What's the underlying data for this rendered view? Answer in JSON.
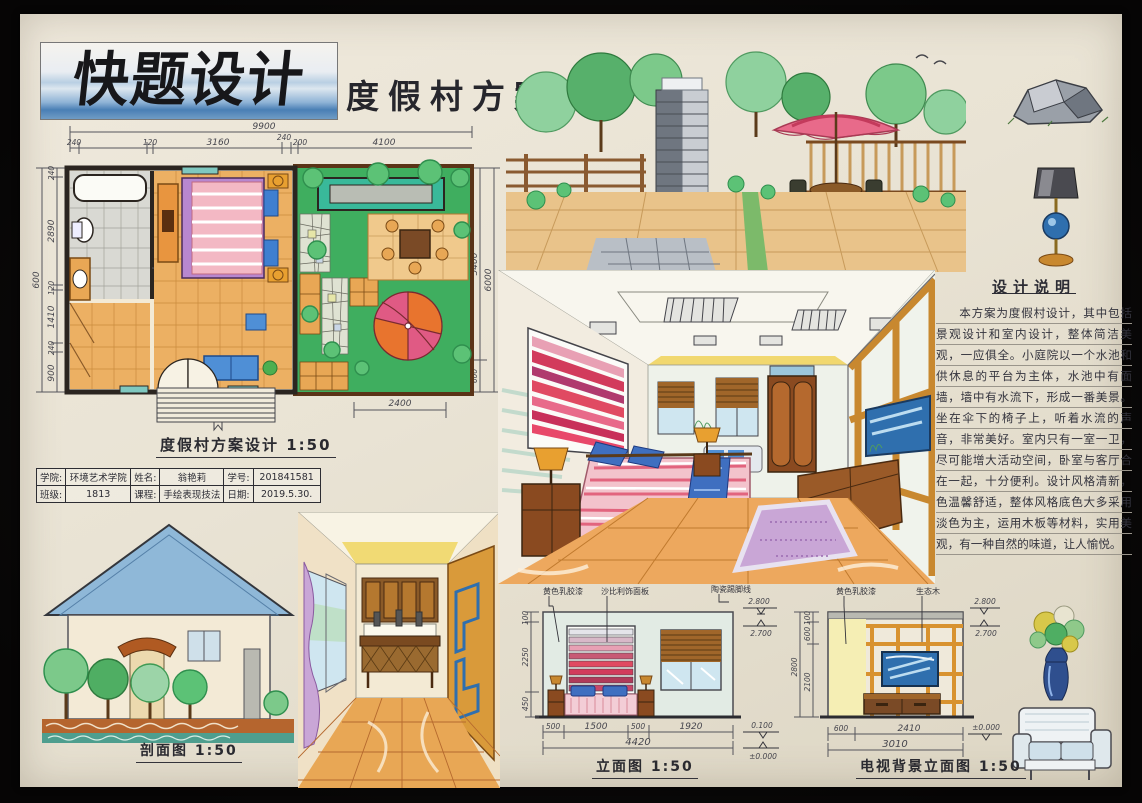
{
  "board": {
    "logo_text": "快题设计",
    "title": "度假村方案"
  },
  "floor_plan": {
    "caption": "度假村方案设计 1:50",
    "dims_top": {
      "overall": "9900",
      "segments": [
        "240",
        "120",
        "3160",
        "240",
        "200",
        "4100"
      ]
    },
    "dims_left": {
      "overall": "600",
      "segments": [
        "240",
        "2890",
        "120",
        "1410",
        "240",
        "900"
      ]
    },
    "dims_right": {
      "inner": "5400",
      "overall": "6000",
      "bottom": "600"
    },
    "dim_bottom": "2400"
  },
  "info_table": {
    "rows": [
      [
        {
          "label": "学院:",
          "value": "环境艺术学院"
        },
        {
          "label": "姓名:",
          "value": "翁艳莉"
        },
        {
          "label": "学号:",
          "value": "201841581"
        }
      ],
      [
        {
          "label": "班级:",
          "value": "1813"
        },
        {
          "label": "课程:",
          "value": "手绘表现技法"
        },
        {
          "label": "日期:",
          "value": "2019.5.30."
        }
      ]
    ]
  },
  "design_notes": {
    "title": "设计说明",
    "body": "本方案为度假村设计，其中包括景观设计和室内设计，整体简洁美观，一应俱全。小庭院以一个水池和供休息的平台为主体，水池中有面墙，墙中有水流下，形成一番美景。坐在伞下的椅子上，听着水流的声音，非常美好。室内只有一室一卫，尽可能增大活动空间，卧室与客厅合在一起，十分便利。设计风格清新，色温馨舒适，整体风格底色大多采用淡色为主，运用木板等材料，实用美观，有一种自然的味道，让人愉悦。"
  },
  "section_view": {
    "caption": "剖面图 1:50"
  },
  "bed_elevation": {
    "caption": "立面图 1:50",
    "labels": [
      "黄色乳胶漆",
      "沙比利饰面板",
      "陶瓷踢脚线"
    ],
    "levels": [
      "2.800",
      "2.700",
      "0.100",
      "±0.000"
    ],
    "dims_left": [
      "100",
      "2250",
      "450"
    ],
    "dims_bottom": [
      "500",
      "1500",
      "500",
      "1920"
    ],
    "dim_total": "4420"
  },
  "tv_elevation": {
    "caption": "电视背景立面图 1:50",
    "labels": [
      "黄色乳胶漆",
      "生态木"
    ],
    "levels": [
      "2.800",
      "2.700",
      "±0.000"
    ],
    "dims_left_overall": "2800",
    "dims_left": [
      "100",
      "600",
      "2100"
    ],
    "dims_bottom": [
      "600",
      "2410"
    ],
    "dim_total": "3010"
  },
  "colors": {
    "paper": "#e9e3d4",
    "frame": "#0a0908",
    "ink": "#2e2e34",
    "marker_blue": "#4a7fb5",
    "marker_green": "#3fae5f",
    "marker_teal": "#4fb9aa",
    "wood_orange": "#e8a755",
    "wood_brown": "#8a4a20",
    "pink": "#e2647e",
    "red": "#d23b5c",
    "purple": "#b887cf",
    "yellow": "#f0d560"
  }
}
